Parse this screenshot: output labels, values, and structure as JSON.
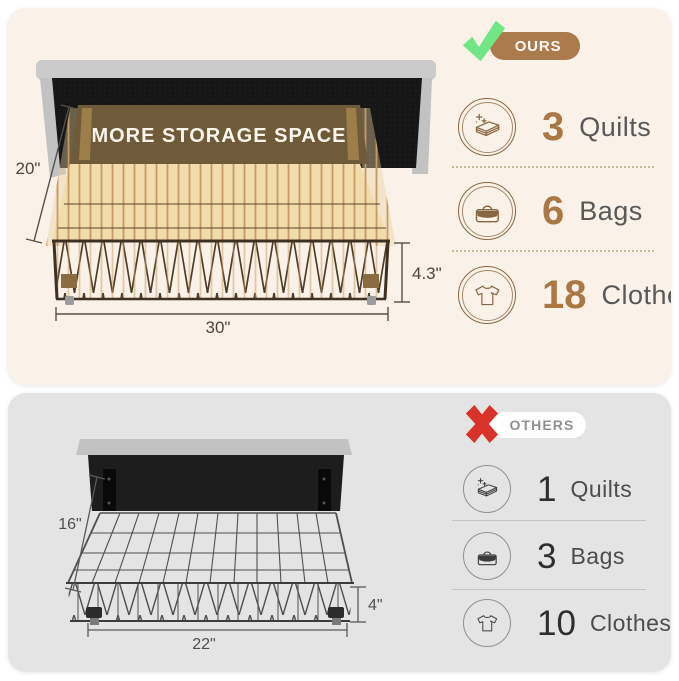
{
  "colors": {
    "cream_bg": "#faf1e8",
    "gray_bg": "#e4e4e4",
    "accent_brown": "#ab7b4d",
    "count_brown": "#aa7745",
    "banner_brown": "#6f5b3a",
    "check_green": "#70e685",
    "cross_red": "#d8322b"
  },
  "ours": {
    "badge_label": "OURS",
    "banner_text": "MORE STORAGE SPACE",
    "dims": {
      "depth": "20\"",
      "side_height": "4.3\"",
      "width": "30\""
    },
    "rows": [
      {
        "icon": "quilt-icon",
        "count": "3",
        "label": "Quilts"
      },
      {
        "icon": "bag-icon",
        "count": "6",
        "label": "Bags"
      },
      {
        "icon": "tshirt-icon",
        "count": "18",
        "label": "Clothes"
      }
    ]
  },
  "others": {
    "badge_label": "OTHERS",
    "dims": {
      "depth": "16\"",
      "side_height": "4\"",
      "width": "22\""
    },
    "rows": [
      {
        "icon": "quilt-icon",
        "count": "1",
        "label": "Quilts"
      },
      {
        "icon": "bag-icon",
        "count": "3",
        "label": "Bags"
      },
      {
        "icon": "tshirt-icon",
        "count": "10",
        "label": "Clothes"
      }
    ]
  }
}
